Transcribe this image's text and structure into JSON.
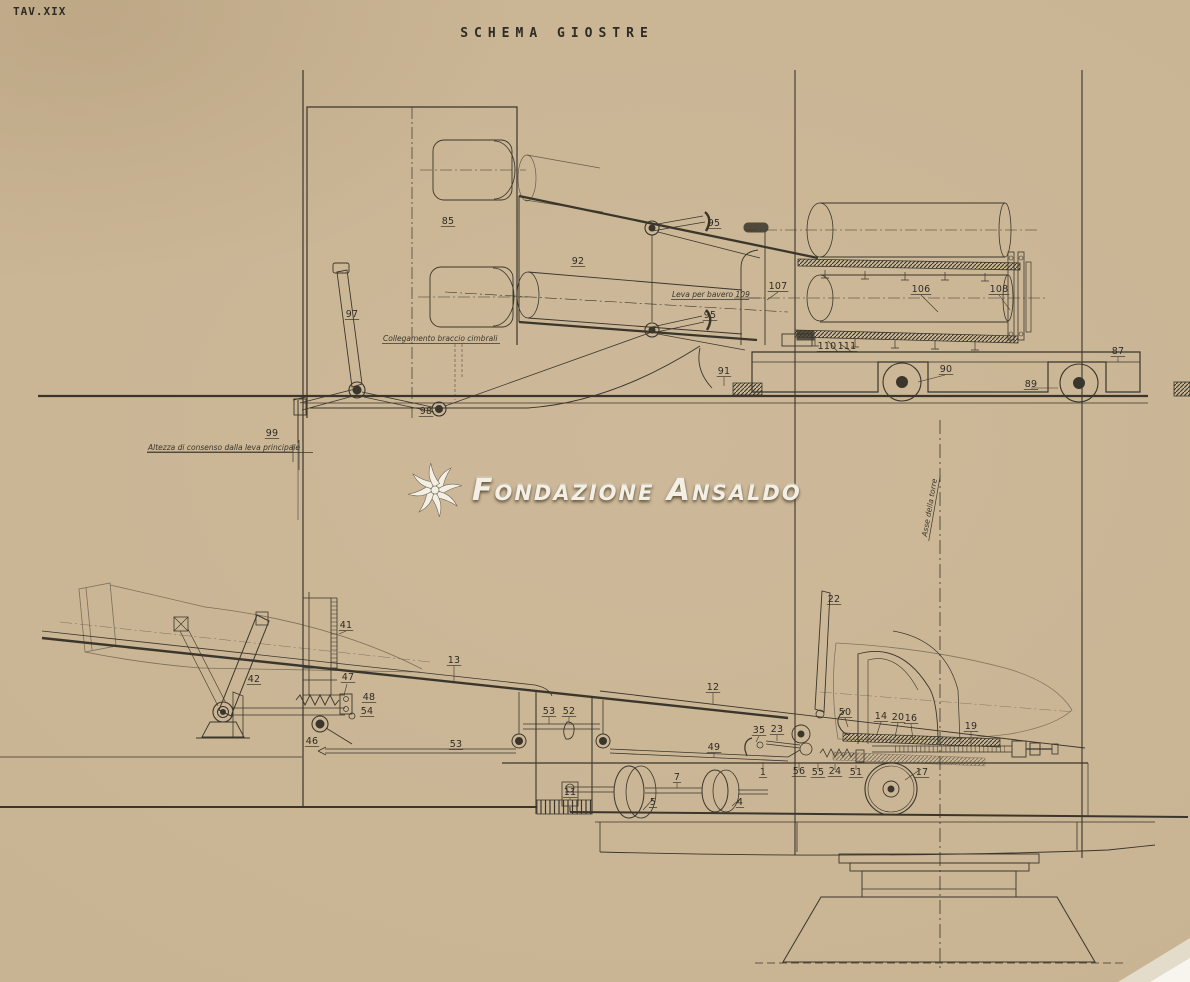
{
  "page": {
    "plate_number": "TAV.XIX",
    "title": "SCHEMA GIOSTRE"
  },
  "watermark": {
    "text": "Fondazione Ansaldo",
    "logo": "ansaldo-turbine-logo",
    "fill": "#f3efe4"
  },
  "colors": {
    "paper": "#c8b392",
    "ink": "#3a362c",
    "label_ink": "#2f2c24"
  },
  "annotations": {
    "upper_view": [
      {
        "text": "Collegamento braccio cimbrali",
        "x": 383,
        "y": 341
      },
      {
        "text": "Leva per bavero 109",
        "x": 672,
        "y": 297
      },
      {
        "text": "Altezza di consenso dalla leva principale",
        "x": 148,
        "y": 450
      }
    ],
    "lower_view": [
      {
        "text": "Asse della torre",
        "x": 932,
        "y": 508,
        "rotate": -80
      }
    ]
  },
  "part_labels": {
    "upper_view": [
      {
        "n": "85",
        "x": 448,
        "y": 224
      },
      {
        "n": "92",
        "x": 578,
        "y": 264
      },
      {
        "n": "95",
        "x": 714,
        "y": 226
      },
      {
        "n": "95",
        "x": 710,
        "y": 318
      },
      {
        "n": "97",
        "x": 352,
        "y": 317
      },
      {
        "n": "98",
        "x": 426,
        "y": 414
      },
      {
        "n": "99",
        "x": 272,
        "y": 436
      },
      {
        "n": "107",
        "x": 778,
        "y": 289
      },
      {
        "n": "106",
        "x": 921,
        "y": 292
      },
      {
        "n": "108",
        "x": 999,
        "y": 292
      },
      {
        "n": "110",
        "x": 827,
        "y": 349
      },
      {
        "n": "111",
        "x": 847,
        "y": 349
      },
      {
        "n": "87",
        "x": 1118,
        "y": 354
      },
      {
        "n": "90",
        "x": 946,
        "y": 372
      },
      {
        "n": "91",
        "x": 724,
        "y": 374
      },
      {
        "n": "89",
        "x": 1031,
        "y": 387
      }
    ],
    "lower_view": [
      {
        "n": "41",
        "x": 346,
        "y": 628
      },
      {
        "n": "13",
        "x": 454,
        "y": 663
      },
      {
        "n": "42",
        "x": 254,
        "y": 682
      },
      {
        "n": "47",
        "x": 348,
        "y": 680
      },
      {
        "n": "48",
        "x": 369,
        "y": 700
      },
      {
        "n": "54",
        "x": 367,
        "y": 714
      },
      {
        "n": "46",
        "x": 312,
        "y": 744
      },
      {
        "n": "53",
        "x": 549,
        "y": 714
      },
      {
        "n": "52",
        "x": 569,
        "y": 714
      },
      {
        "n": "53",
        "x": 456,
        "y": 747
      },
      {
        "n": "12",
        "x": 713,
        "y": 690
      },
      {
        "n": "22",
        "x": 834,
        "y": 602
      },
      {
        "n": "50",
        "x": 845,
        "y": 715
      },
      {
        "n": "14",
        "x": 881,
        "y": 719
      },
      {
        "n": "20",
        "x": 898,
        "y": 720
      },
      {
        "n": "16",
        "x": 911,
        "y": 721
      },
      {
        "n": "19",
        "x": 971,
        "y": 729
      },
      {
        "n": "35",
        "x": 759,
        "y": 733
      },
      {
        "n": "23",
        "x": 777,
        "y": 732
      },
      {
        "n": "49",
        "x": 714,
        "y": 750
      },
      {
        "n": "1",
        "x": 763,
        "y": 775
      },
      {
        "n": "56",
        "x": 799,
        "y": 774
      },
      {
        "n": "55",
        "x": 818,
        "y": 775
      },
      {
        "n": "24",
        "x": 835,
        "y": 774
      },
      {
        "n": "51",
        "x": 856,
        "y": 775
      },
      {
        "n": "17",
        "x": 922,
        "y": 775
      },
      {
        "n": "7",
        "x": 677,
        "y": 780
      },
      {
        "n": "5",
        "x": 653,
        "y": 805
      },
      {
        "n": "4",
        "x": 740,
        "y": 805
      },
      {
        "n": "11",
        "x": 570,
        "y": 795
      }
    ]
  }
}
